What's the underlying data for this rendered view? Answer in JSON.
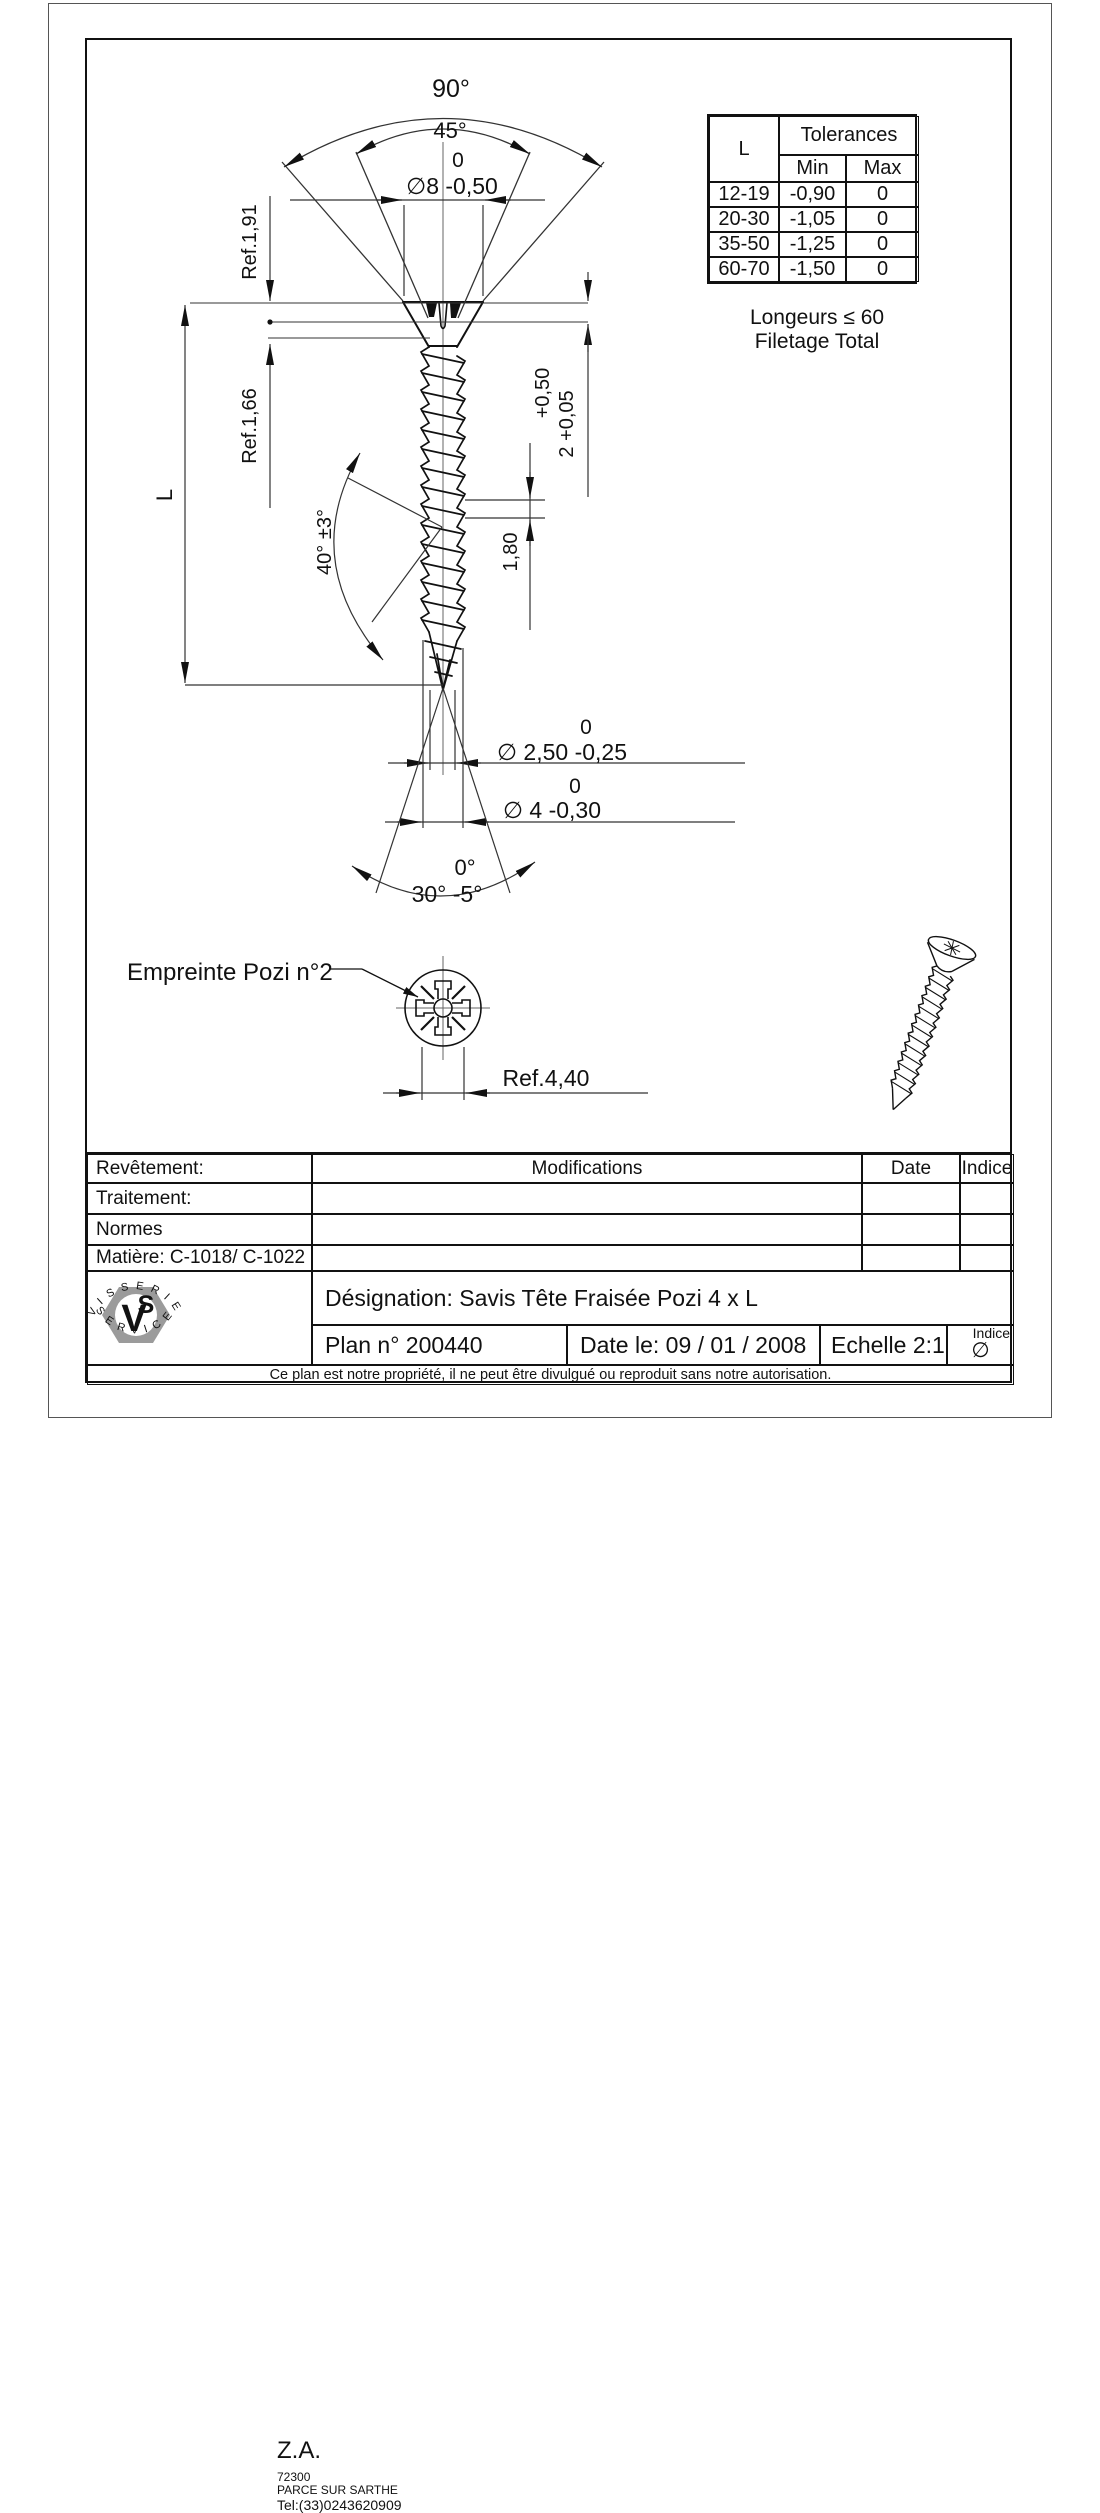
{
  "colors": {
    "ink": "#111111",
    "thin_line": "#333333",
    "logo_gray": "#9b9b9b"
  },
  "front_view": {
    "angle_90": "90°",
    "angle_45": "45°",
    "dia_head_upper": "0",
    "dia_head": "∅8 -0,50",
    "ref_head_od": "Ref.1,91",
    "ref_head_height": "Ref.1,66",
    "length_label": "L",
    "head_height_tol_upper": "+0,50",
    "head_height": "2 +0,05",
    "flank_angle": "40° ±3°",
    "pitch": "1,80",
    "core_dia_upper": "0",
    "core_dia": "∅ 2,50 -0,25",
    "outer_dia_upper": "0",
    "outer_dia": "∅ 4 -0,30",
    "tip_angle_upper": "0°",
    "tip_angle": "30° -5°"
  },
  "notes": {
    "line1": "Longeurs ≤ 60",
    "line2": "Filetage Total"
  },
  "tolerance_table": {
    "l_header": "L",
    "tolerances_header": "Tolerances",
    "min_header": "Min",
    "max_header": "Max",
    "rows": [
      [
        "12-19",
        "-0,90",
        "0"
      ],
      [
        "20-30",
        "-1,05",
        "0"
      ],
      [
        "35-50",
        "-1,25",
        "0"
      ],
      [
        "60-70",
        "-1,50",
        "0"
      ]
    ]
  },
  "head_view": {
    "label": "Empreinte Pozi n°2",
    "ref": "Ref.4,40"
  },
  "title_block": {
    "revetement": "Revêtement:",
    "traitement": "Traitement:",
    "normes": "Normes",
    "matiere": "Matière: C-1018/ C-1022",
    "modifications": "Modifications",
    "date": "Date",
    "indice": "Indice",
    "designation": "Désignation: Savis Tête Fraisée Pozi 4 x L",
    "plan_no": "Plan n° 200440",
    "date_le": "Date le: 09 / 01 / 2008",
    "echelle": "Echelle 2:1",
    "indice_label": "Indice",
    "indice_value": "∅",
    "company": {
      "za": "Z.A.",
      "postal": "72300",
      "city": "PARCE SUR SARTHE",
      "tel": "Tel:(33)0243620909",
      "arc_top": "VISSERIE",
      "arc_bottom": "SERVICE",
      "monogram_v": "V",
      "monogram_s": "S"
    }
  },
  "footer": "Ce plan est notre propriété, il ne peut être divulgué ou reproduit sans notre autorisation."
}
